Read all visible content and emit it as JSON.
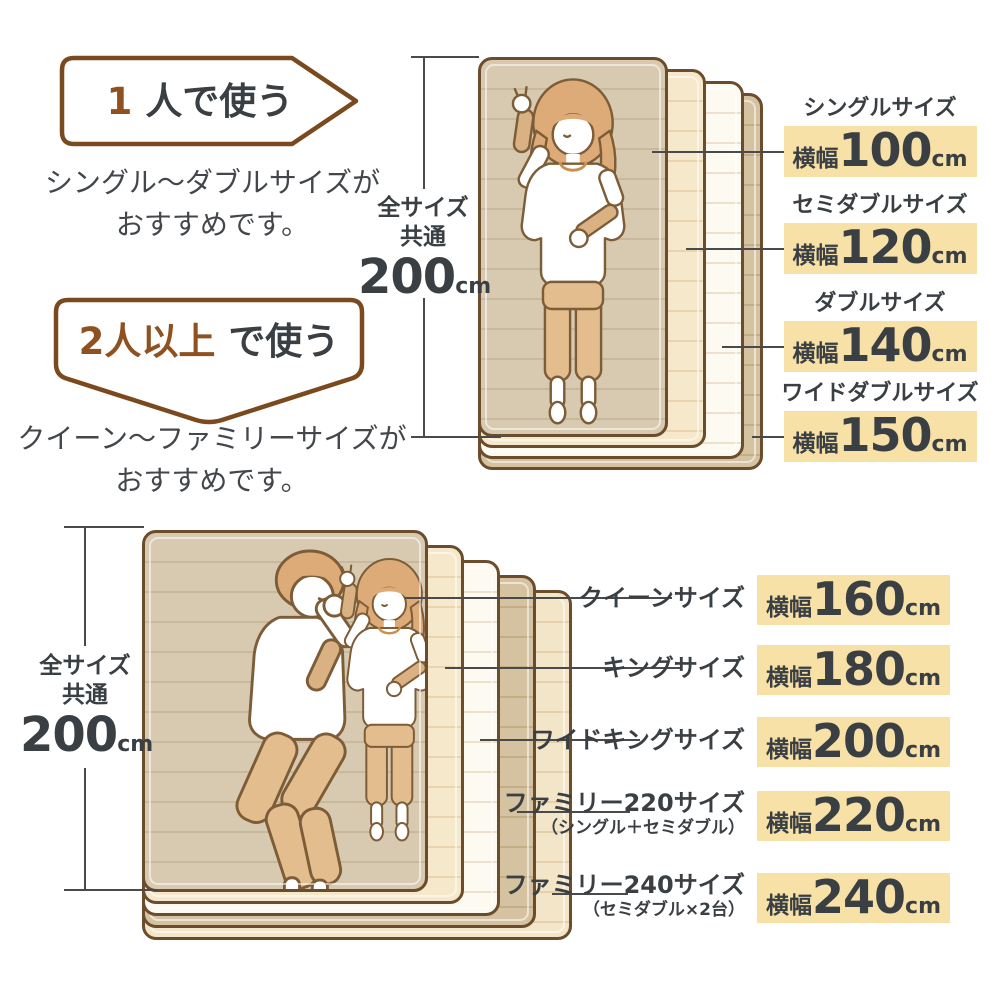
{
  "colors": {
    "accent_brown": "#8f5120",
    "banner_border": "#7a4a1e",
    "text_dark": "#3a3f44",
    "highlight": "#f7e1a6",
    "connector_line": "#4a4a4a",
    "mattress_border": "#6b4c2c",
    "mattress_tan": "#d8cab0",
    "mattress_cream": "#f6e8ca",
    "mattress_white": "#fdfaf1",
    "mattress_dark_tan": "#d4c2a0"
  },
  "single_use": {
    "banner_accent": "1",
    "banner_rest": "人で使う",
    "desc_line1": "シングル〜ダブルサイズが",
    "desc_line2": "おすすめです。"
  },
  "multi_use": {
    "banner_accent": "2人以上",
    "banner_rest": "で使う",
    "desc_line1": "クイーン〜ファミリーサイズが",
    "desc_line2": "おすすめです。"
  },
  "length_dim": {
    "line1": "全サイズ",
    "line2": "共通",
    "value": "200",
    "unit": "cm"
  },
  "width_label": "横幅",
  "unit": "cm",
  "top_sizes": [
    {
      "name": "シングルサイズ",
      "width": "100"
    },
    {
      "name": "セミダブルサイズ",
      "width": "120"
    },
    {
      "name": "ダブルサイズ",
      "width": "140"
    },
    {
      "name": "ワイドダブルサイズ",
      "width": "150"
    }
  ],
  "bottom_sizes": [
    {
      "name": "クイーンサイズ",
      "width": "160"
    },
    {
      "name": "キングサイズ",
      "width": "180"
    },
    {
      "name": "ワイドキングサイズ",
      "width": "200"
    },
    {
      "name": "ファミリー220サイズ",
      "sub": "（シングル＋セミダブル）",
      "width": "220"
    },
    {
      "name": "ファミリー240サイズ",
      "sub": "（セミダブル×2台）",
      "width": "240"
    }
  ]
}
